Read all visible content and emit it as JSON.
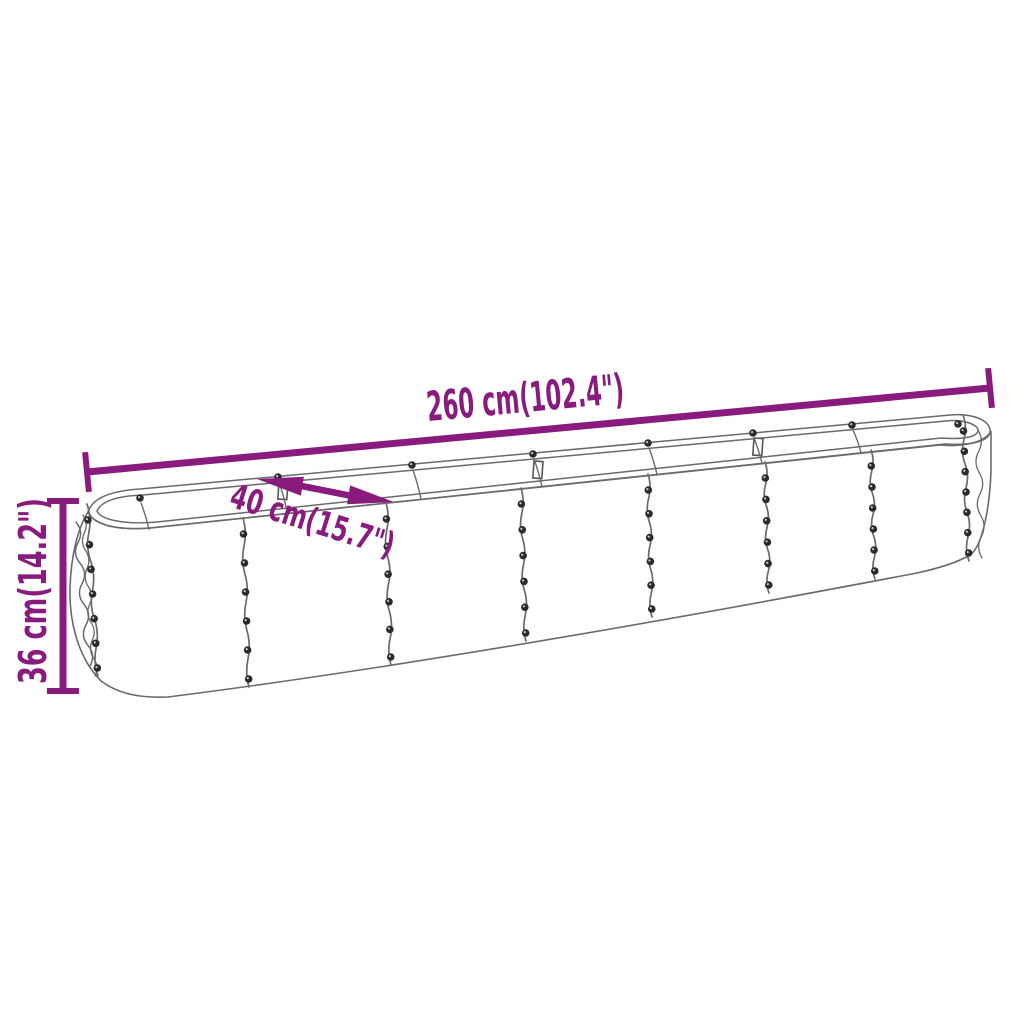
{
  "page": {
    "background": "#ffffff"
  },
  "diagram": {
    "kind": "product-dimension-diagram",
    "product": "galvanised-steel-raised-garden-bed",
    "colors": {
      "dimension_accent": "#8a1b7e",
      "product_outline": "#6a6a6a",
      "rivet": "#2b2b2b",
      "background": "#ffffff"
    },
    "dimensions": {
      "length": {
        "label": "260 cm(102.4\")",
        "cm": 260,
        "inches": 102.4
      },
      "width": {
        "label": "40 cm(15.7\")",
        "cm": 40,
        "inches": 15.7
      },
      "height": {
        "label": "36 cm(14.2\")",
        "cm": 36,
        "inches": 14.2
      }
    }
  }
}
